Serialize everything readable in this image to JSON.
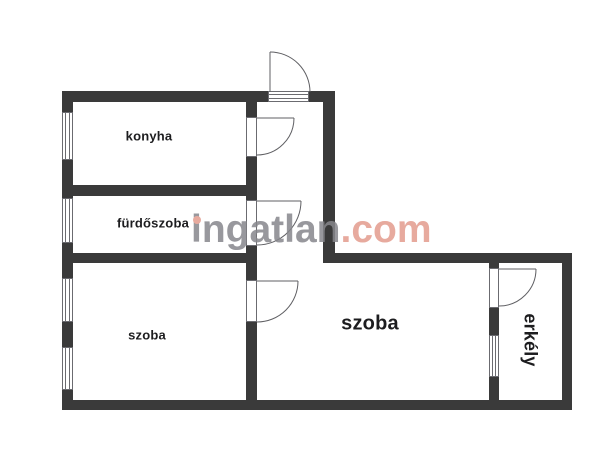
{
  "page": {
    "type": "apartment-floor-plan"
  },
  "rooms": [
    {
      "id": "konyha",
      "label": "konyha"
    },
    {
      "id": "furdoszoba",
      "label": "fürdőszoba"
    },
    {
      "id": "szoba_small",
      "label": "szoba"
    },
    {
      "id": "szoba_large",
      "label": "szoba"
    },
    {
      "id": "erkely",
      "label": "erkély"
    }
  ],
  "watermark": {
    "brand": "ingatlan",
    "tld": ".com",
    "brand_color": "#87878c",
    "tld_color": "#e39c8e"
  },
  "colors": {
    "wall": "#3a3a3a",
    "symbol_line": "#6b6b70",
    "background": "#ffffff",
    "label_text": "#1d1d1f"
  }
}
